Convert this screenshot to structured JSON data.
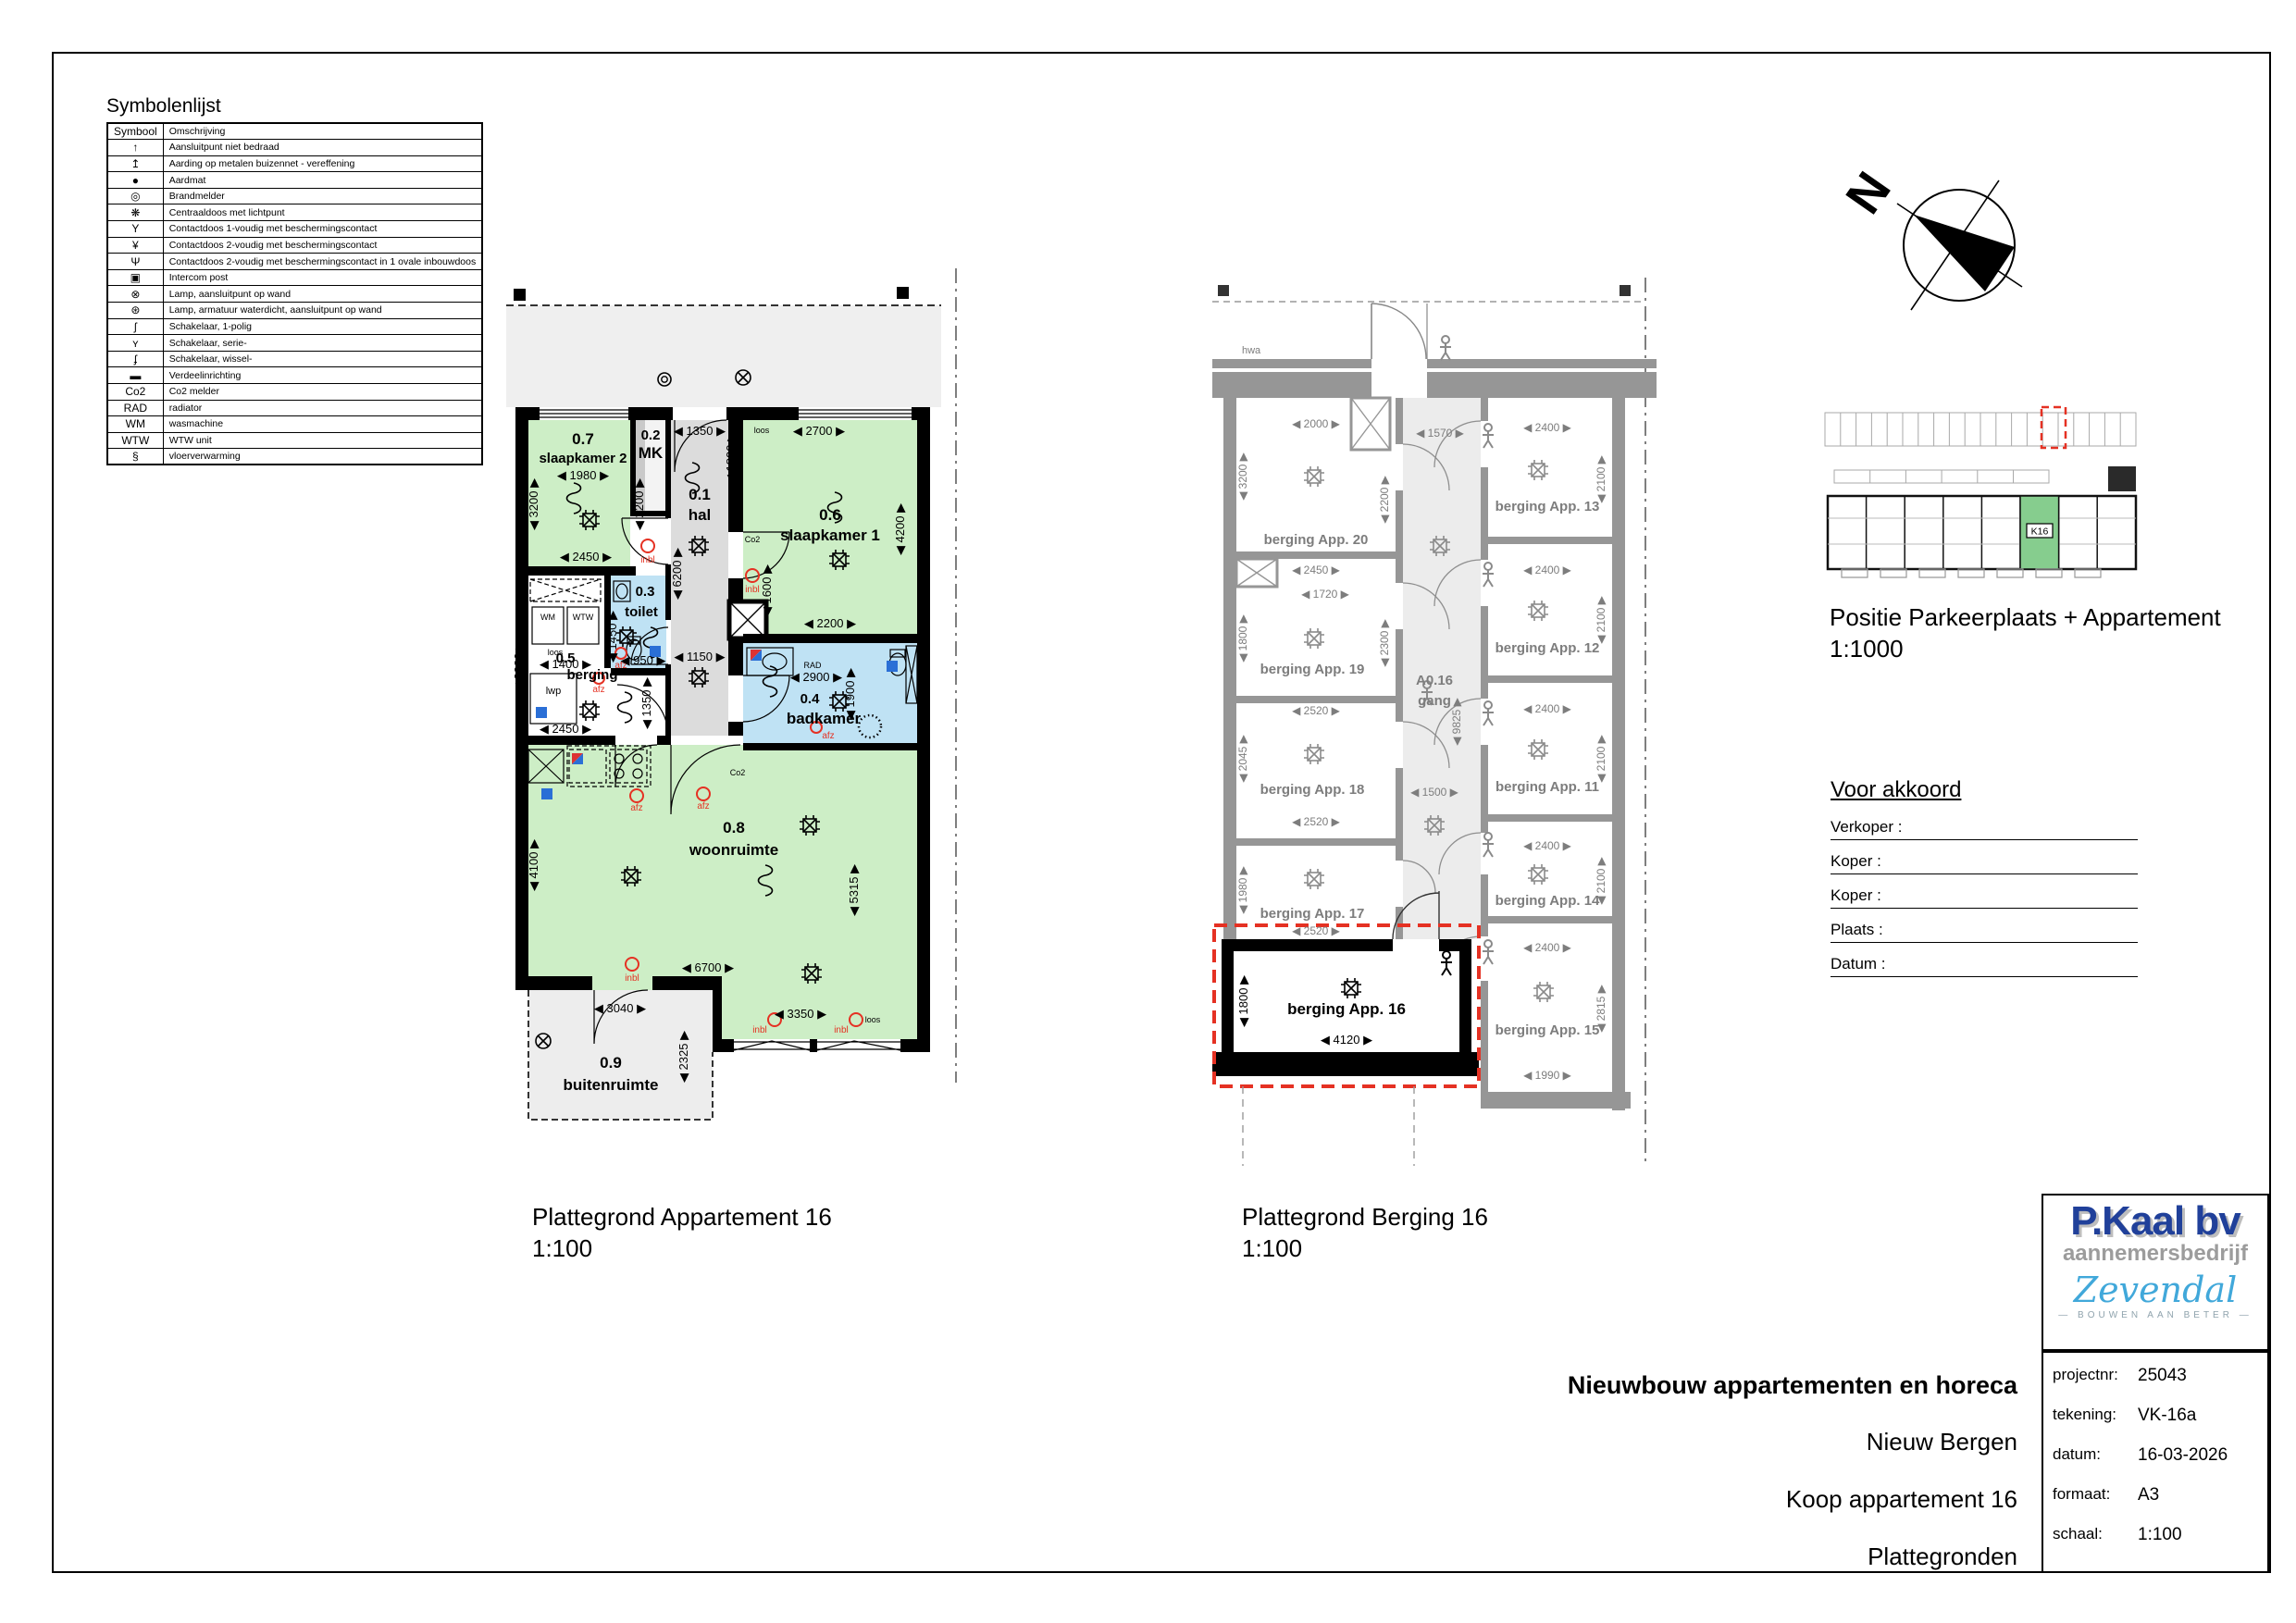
{
  "symbol_list": {
    "title": "Symbolenlijst",
    "headers": {
      "symbol": "Symbool",
      "description": "Omschrijving"
    },
    "rows": [
      {
        "symbol": "↑",
        "description": "Aansluitpunt niet bedraad"
      },
      {
        "symbol": "↥",
        "description": "Aarding op metalen buizennet - vereffening"
      },
      {
        "symbol": "●",
        "description": "Aardmat"
      },
      {
        "symbol": "◎",
        "description": "Brandmelder"
      },
      {
        "symbol": "❋",
        "description": "Centraaldoos met lichtpunt"
      },
      {
        "symbol": "Y",
        "description": "Contactdoos 1-voudig met beschermingscontact"
      },
      {
        "symbol": "¥",
        "description": "Contactdoos 2-voudig met beschermingscontact"
      },
      {
        "symbol": "Ψ",
        "description": "Contactdoos 2-voudig met beschermingscontact in 1 ovale inbouwdoos"
      },
      {
        "symbol": "▣",
        "description": "Intercom post"
      },
      {
        "symbol": "⊗",
        "description": "Lamp, aansluitpunt op wand"
      },
      {
        "symbol": "⊛",
        "description": "Lamp, armatuur waterdicht, aansluitpunt op wand"
      },
      {
        "symbol": "ʃ",
        "description": "Schakelaar, 1-polig"
      },
      {
        "symbol": "ʏ",
        "description": "Schakelaar, serie-"
      },
      {
        "symbol": "ʄ",
        "description": "Schakelaar, wissel-"
      },
      {
        "symbol": "▬",
        "description": "Verdeelinrichting"
      },
      {
        "symbol": "Co2",
        "description": "Co2 melder"
      },
      {
        "symbol": "RAD",
        "description": "radiator"
      },
      {
        "symbol": "WM",
        "description": "wasmachine"
      },
      {
        "symbol": "WTW",
        "description": "WTW unit"
      },
      {
        "symbol": "§",
        "description": "vloerverwarming"
      }
    ]
  },
  "north": {
    "label": "N"
  },
  "position_plan": {
    "caption": "Positie Parkeerplaats + Appartement",
    "scale": "1:1000",
    "unit": "K16"
  },
  "approval": {
    "title": "Voor akkoord",
    "fields": [
      {
        "label": "Verkoper :"
      },
      {
        "label": "Koper :"
      },
      {
        "label": "Koper :"
      },
      {
        "label": "Plaats :"
      },
      {
        "label": "Datum :"
      }
    ]
  },
  "apartment_plan": {
    "caption": "Plattegrond Appartement 16",
    "scale": "1:100",
    "rooms": {
      "r01": {
        "num": "0.1",
        "name": "hal"
      },
      "r02": {
        "num": "0.2",
        "name": "MK"
      },
      "r03": {
        "num": "0.3",
        "name": "toilet"
      },
      "r04": {
        "num": "0.4",
        "name": "badkamer"
      },
      "r05": {
        "num": "0.5",
        "name": "berging"
      },
      "r06": {
        "num": "0.6",
        "name": "slaapkamer 1"
      },
      "r07": {
        "num": "0.7",
        "name": "slaapkamer 2"
      },
      "r08": {
        "num": "0.8",
        "name": "woonruimte"
      },
      "r09": {
        "num": "0.9",
        "name": "buitenruimte"
      }
    },
    "dims": {
      "slk2_w": "1980",
      "slk2_h": "3200",
      "slk2_h2": "2200",
      "slk2_w2": "2450",
      "hal_w": "1350",
      "hal_h": "1800",
      "hal_len": "6200",
      "hal_w2": "1150",
      "slk1_w": "2700",
      "slk1_h": "4200",
      "slk1_h2": "1600",
      "slk1_w2": "2200",
      "toilet_h": "1450",
      "toilet_w": "950",
      "berg_w": "1400",
      "berg_h": "2380",
      "berg_h2": "1350",
      "berg_w2": "2450",
      "bad_w": "2900",
      "bad_h": "1900",
      "woon_h": "4100",
      "woon_h2": "5315",
      "woon_w": "6700",
      "woon_w2": "3350",
      "buiten_w": "3040",
      "buiten_h": "2325"
    },
    "labels": {
      "wm": "WM",
      "wtw": "WTW",
      "loos": "loos",
      "lwp": "lwp",
      "rad": "RAD",
      "co2": "Co2",
      "inbl": "inbl",
      "afz": "afz"
    }
  },
  "berging_plan": {
    "caption": "Plattegrond Berging 16",
    "scale": "1:100",
    "corridor": {
      "num": "A0.16",
      "name": "gang"
    },
    "rooms": {
      "app20": "berging App. 20",
      "app19": "berging App. 19",
      "app18": "berging App. 18",
      "app17": "berging App. 17",
      "app16": "berging App. 16",
      "app13": "berging App. 13",
      "app12": "berging App. 12",
      "app11": "berging App. 11",
      "app14": "berging App. 14",
      "app15": "berging App. 15"
    },
    "dims": {
      "a20_w": "2000",
      "a20_h": "3200",
      "a20_h2": "2200",
      "a20_w2": "2450",
      "a19_w": "1720",
      "a19_h": "1800",
      "a19_h2": "2300",
      "a19_w2": "2520",
      "a18_h": "2045",
      "a18_w": "2520",
      "a17_h": "1980",
      "a17_w": "2520",
      "a16_h": "1800",
      "a16_w": "4120",
      "gang_w": "1570",
      "gang_len": "9825",
      "gang_w2": "1500",
      "a13_w": "2400",
      "a13_h": "2100",
      "a12_w": "2400",
      "a12_h": "2100",
      "a11_w": "2400",
      "a11_h": "2100",
      "a14_w": "2400",
      "a14_h": "2100",
      "a15_w": "2400",
      "a15_h": "2815",
      "a15_w2": "1990"
    },
    "labels": {
      "hwa": "hwa"
    }
  },
  "title_block": {
    "project_title": "Nieuwbouw appartementen en horeca",
    "location": "Nieuw Bergen",
    "subject": "Koop appartement 16",
    "sheet": "Plattegronden",
    "logos": {
      "primary": "P.Kaal bv",
      "primary_sub": "aannemersbedrijf",
      "secondary": "Zevendal",
      "secondary_sub": "—  BOUWEN AAN BETER  —"
    },
    "fields": [
      {
        "label": "projectnr:",
        "value": "25043"
      },
      {
        "label": "tekening:",
        "value": "VK-16a"
      },
      {
        "label": "datum:",
        "value": "16-03-2026"
      },
      {
        "label": "formaat:",
        "value": "A3"
      },
      {
        "label": "schaal:",
        "value": "1:100"
      }
    ]
  }
}
